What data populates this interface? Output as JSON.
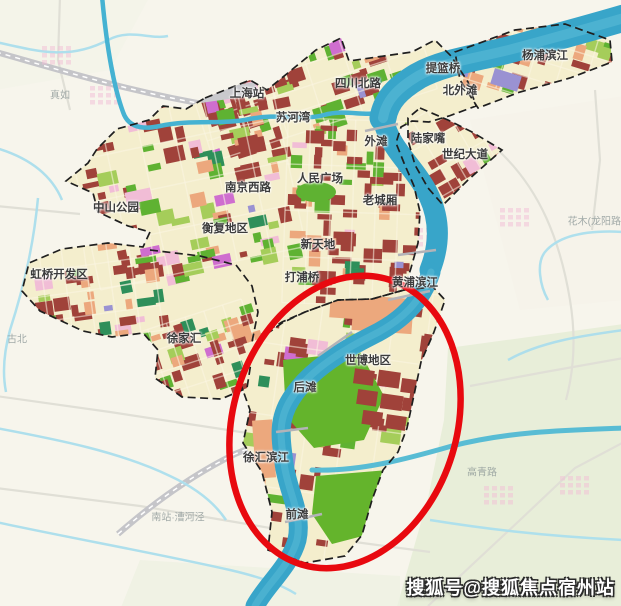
{
  "watermark": {
    "text": "搜狐号@搜狐焦点宿州站"
  },
  "labels": {
    "districts": [
      {
        "text": "上海站",
        "x": 247,
        "y": 93
      },
      {
        "text": "四川北路",
        "x": 358,
        "y": 83
      },
      {
        "text": "提篮桥",
        "x": 443,
        "y": 68
      },
      {
        "text": "杨浦滨江",
        "x": 545,
        "y": 55
      },
      {
        "text": "北外滩",
        "x": 460,
        "y": 90
      },
      {
        "text": "苏河湾",
        "x": 293,
        "y": 117
      },
      {
        "text": "外滩",
        "x": 376,
        "y": 141
      },
      {
        "text": "陆家嘴",
        "x": 428,
        "y": 138
      },
      {
        "text": "世纪大道",
        "x": 465,
        "y": 154
      },
      {
        "text": "南京西路",
        "x": 248,
        "y": 187
      },
      {
        "text": "人民广场",
        "x": 320,
        "y": 178
      },
      {
        "text": "中山公园",
        "x": 116,
        "y": 207
      },
      {
        "text": "老城厢",
        "x": 380,
        "y": 200
      },
      {
        "text": "衡复地区",
        "x": 225,
        "y": 228
      },
      {
        "text": "新天地",
        "x": 318,
        "y": 244
      },
      {
        "text": "虹桥开发区",
        "x": 59,
        "y": 274
      },
      {
        "text": "打浦桥",
        "x": 302,
        "y": 277
      },
      {
        "text": "黄浦滨江",
        "x": 415,
        "y": 282
      },
      {
        "text": "徐家汇",
        "x": 184,
        "y": 338
      },
      {
        "text": "世博地区",
        "x": 368,
        "y": 360
      },
      {
        "text": "后滩",
        "x": 305,
        "y": 387
      },
      {
        "text": "徐汇滨江",
        "x": 266,
        "y": 457
      },
      {
        "text": "前滩",
        "x": 297,
        "y": 514
      }
    ],
    "faint": [
      {
        "text": "真如",
        "x": 60,
        "y": 94
      },
      {
        "text": "古北",
        "x": 17,
        "y": 338
      },
      {
        "text": "高青路",
        "x": 482,
        "y": 471
      },
      {
        "text": "花木(龙阳路)",
        "x": 596,
        "y": 220
      },
      {
        "text": "南站·漕河泾",
        "x": 178,
        "y": 516
      }
    ]
  },
  "highlight": {
    "shape": "ellipse",
    "cx": 345,
    "cy": 422,
    "rx": 112,
    "ry": 149,
    "rotation": 17,
    "color": "#e8090f"
  },
  "colors": {
    "bg_outside": "#f7f5ec",
    "city_fill": "#f4eecd",
    "river": "#38a5c9",
    "river_light": "#66c3dc",
    "creek": "#45b2d2",
    "canal": "#abdeed",
    "boundary": "#1f1f1f",
    "parcel_red": "#a0423a",
    "parcel_orange": "#eca87d",
    "parcel_green": "#5fb232",
    "parcel_lightgreen": "#a5cd5a",
    "parcel_darkgreen": "#2e8f5a",
    "parcel_pink": "#f1bdd6",
    "parcel_magenta": "#cf6ecf",
    "parcel_purple": "#9a92d2",
    "road_outside": "#e0dfd6",
    "rail": "#c5c5c9",
    "street": "#fbf6e3",
    "label": "#3c3c3c",
    "label_faint": "#8d9898"
  }
}
